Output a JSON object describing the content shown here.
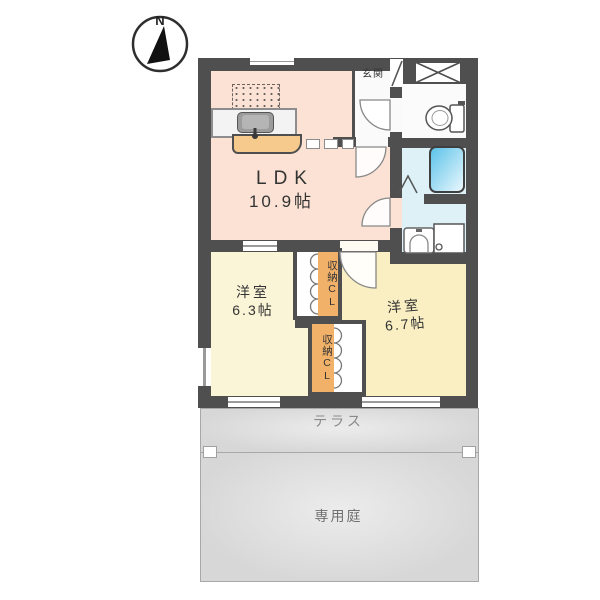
{
  "title": "floor-plan",
  "compass": {
    "north_label": "N"
  },
  "plan": {
    "ldk": {
      "label": "LDK",
      "area": "10.9帖"
    },
    "entrance": {
      "label": "玄関"
    },
    "bedroom_left": {
      "label": "洋室",
      "area": "6.3帖"
    },
    "bedroom_right": {
      "label": "洋室",
      "area": "6.7帖"
    },
    "closet_upper": {
      "label": "収納CL"
    },
    "closet_lower": {
      "label": "収納CL"
    },
    "terrace": {
      "label": "テラス"
    },
    "garden": {
      "label": "専用庭"
    }
  },
  "fixtures": [
    "compass-icon",
    "kitchen-sink-icon",
    "stove-hatch-icon",
    "toilet-icon",
    "bathtub-icon",
    "washbasin-icon",
    "washer-pan-icon",
    "shoe-box-icon",
    "door-swing-icon",
    "bifold-door-icon"
  ],
  "colors": {
    "wall": "#4f4f4f",
    "ldk": "#fbe2d4",
    "yellowLeft": "#fbf5d8",
    "yellowRight": "#f9efc3",
    "wet": "#ddf1f7",
    "closet": "#f1b169",
    "counter": "#f6c98d",
    "terrace": "#d7d7d7",
    "tub": "#58c1e8",
    "text": "#333333",
    "mutedText": "#8a8a8a"
  }
}
